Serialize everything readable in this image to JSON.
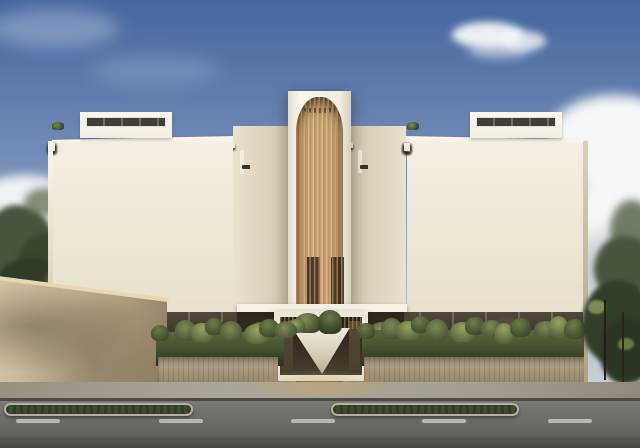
{
  "scene": {
    "type": "architectural-render",
    "description": "Frontal daytime rendering of a modern five-storey condominium: white stacked balconies on both wings, a central arched tower clad in vertical timber slats over the entrance portal, lush hedge planters along the base, a beige perimeter wall with trees at left, tropical vegetation at right, and a street with grass medians and dashed lane markings in the foreground",
    "time_of_day": "day",
    "sky_condition": "blue sky with scattered white clouds"
  },
  "building": {
    "floors": 5,
    "wing_columns": 3,
    "mid_section_columns": 1,
    "penthouse_levels": 1,
    "tower": {
      "material": "vertical timber slats",
      "top": "arched recess",
      "slot_doors": 2
    },
    "entrance": {
      "portal": "white rectangular frame",
      "planter": "V-shaped white planter with plants"
    }
  },
  "street": {
    "lane_dashes": 5,
    "medians": 2,
    "median_surface": "grass"
  },
  "vegetation": {
    "hedges": 2,
    "tree_cluster_left": 1,
    "tree_cluster_right": 1,
    "balcony_plants": true
  },
  "colors": {
    "sky-top": "#44669f",
    "sky-mid": "#7d94bb",
    "sky-low": "#ccd2d6",
    "cloud": "#f4f6f8",
    "facade": "#f3eee1",
    "facade-bright": "#faf6eb",
    "facade-shade": "#d8d1bf",
    "slab": "#f5f0e2",
    "win-hi": "#b7af9d",
    "win-mid": "#7b7365",
    "win-lo": "#6f675a",
    "wood-hi": "#d9b685",
    "wood-mid": "#c89d6c",
    "wood-lo": "#93693f",
    "interior": "#2c251b",
    "hedge-hi": "#7d8a52",
    "hedge-mid": "#4a5634",
    "hedge-lo": "#39442c",
    "stone-hi": "#bcab90",
    "stone-lo": "#94836a",
    "wall-hi": "#d6c6a8",
    "wall-lo": "#8e7c62",
    "sidewalk": "#aaa599",
    "road-hi": "#6f6e6a",
    "road-lo": "#595853",
    "grass": "#3c4a31",
    "curb": "#b5afa0",
    "dash": "#c9c3b4",
    "tree-hi": "#6f7c49",
    "tree-mid": "#4a5540",
    "tree-lo": "#313c28"
  }
}
